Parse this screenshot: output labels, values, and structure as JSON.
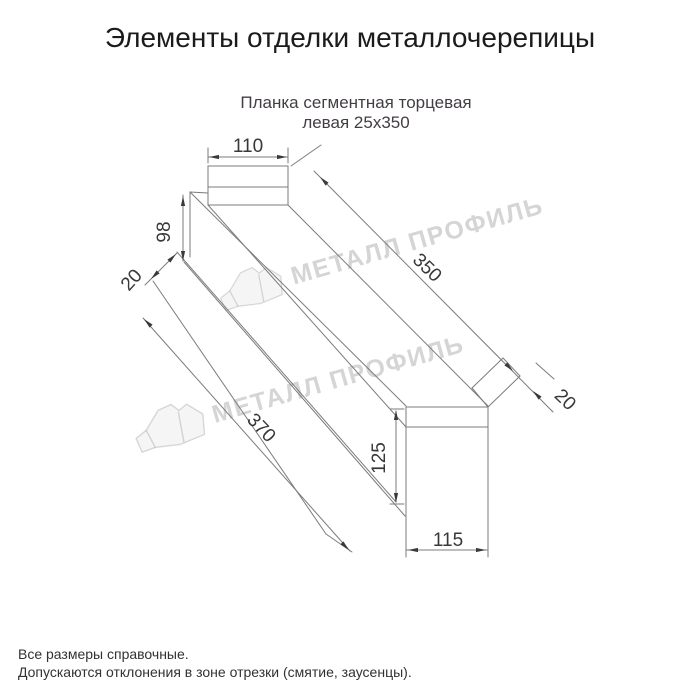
{
  "page": {
    "title": "Элементы отделки металлочерепицы"
  },
  "product": {
    "subtitle_line1": "Планка сегментная торцевая",
    "subtitle_line2": "левая 25х350"
  },
  "watermark": {
    "text": "МЕТАЛЛ ПРОФИЛЬ"
  },
  "drawing": {
    "dim_top_width": "110",
    "dim_left_height": "98",
    "dim_left_fold": "20",
    "dim_length_top": "350",
    "dim_length_bottom": "370",
    "dim_right_fold": "20",
    "dim_right_height": "125",
    "dim_bottom_width": "115"
  },
  "notes": {
    "line1": "Все размеры справочные.",
    "line2": "Допускаются отклонения в зоне отрезки (смятие, заусенцы)."
  },
  "colors": {
    "line": "#7b7b7b",
    "dim_text": "#383838",
    "title_text": "#1b1b1b",
    "watermark": "#d5d5d5",
    "background": "#ffffff"
  }
}
